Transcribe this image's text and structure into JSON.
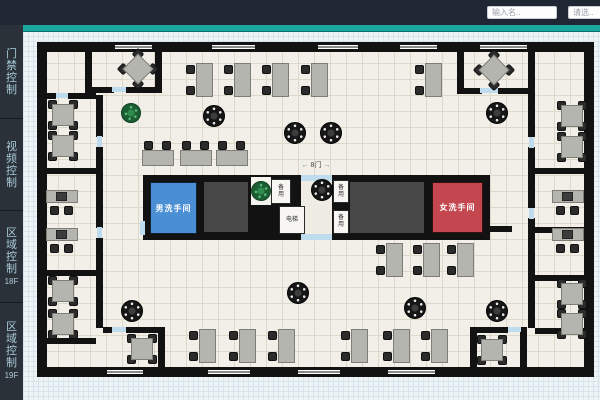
{
  "header": {
    "search_placeholder": "输入名..",
    "select_placeholder": "请选.."
  },
  "sidebar": {
    "items": [
      {
        "label": "门禁控制",
        "sub": ""
      },
      {
        "label": "视频控制",
        "sub": ""
      },
      {
        "label": "区域控制",
        "sub": "18F"
      },
      {
        "label": "区域控制",
        "sub": "19F"
      }
    ]
  },
  "floorplan": {
    "labels": {
      "mens_room": "男洗手间",
      "womens_room": "女洗手间",
      "elevator": "电梯",
      "utility_1": "备用",
      "utility_2": "备用",
      "utility_3": "备用",
      "door_sign": "8门",
      "arrow_left": "←",
      "arrow_right": "→"
    },
    "colors": {
      "accent_teal": "#1aa7a2",
      "mens_room_blue": "#4a8fd4",
      "womens_room_red": "#c4474f",
      "wall_black": "#121212",
      "door_mark_blue": "#bfdcef",
      "plant_green": "#1c6436",
      "table_gray": "#b5b5b0"
    }
  },
  "furniture": {
    "round_tables": [
      [
        214,
        116
      ],
      [
        295,
        133
      ],
      [
        331,
        133
      ],
      [
        497,
        113
      ],
      [
        322,
        190
      ],
      [
        132,
        311
      ],
      [
        298,
        293
      ],
      [
        415,
        308
      ],
      [
        497,
        311
      ]
    ],
    "plants": [
      [
        131,
        113
      ],
      [
        261,
        191
      ]
    ],
    "square_tables": [
      [
        63,
        115
      ],
      [
        63,
        146
      ],
      [
        63,
        291
      ],
      [
        63,
        324
      ],
      [
        572,
        116
      ],
      [
        572,
        147
      ],
      [
        572,
        294
      ],
      [
        572,
        324
      ],
      [
        142,
        349
      ],
      [
        492,
        350
      ]
    ],
    "rotated_tables": [
      [
        138,
        69
      ],
      [
        494,
        70
      ]
    ],
    "desks_v": [
      [
        200,
        80
      ],
      [
        238,
        80
      ],
      [
        276,
        80
      ],
      [
        315,
        80
      ],
      [
        429,
        80
      ],
      [
        390,
        260
      ],
      [
        427,
        260
      ],
      [
        461,
        260
      ],
      [
        203,
        346
      ],
      [
        243,
        346
      ],
      [
        282,
        346
      ],
      [
        355,
        346
      ],
      [
        397,
        346
      ],
      [
        435,
        346
      ]
    ],
    "desks_h": [
      [
        158,
        154
      ],
      [
        196,
        154
      ],
      [
        232,
        154
      ]
    ],
    "pc_desks": [
      [
        62,
        204
      ],
      [
        62,
        242
      ],
      [
        568,
        204
      ],
      [
        568,
        242
      ]
    ]
  }
}
